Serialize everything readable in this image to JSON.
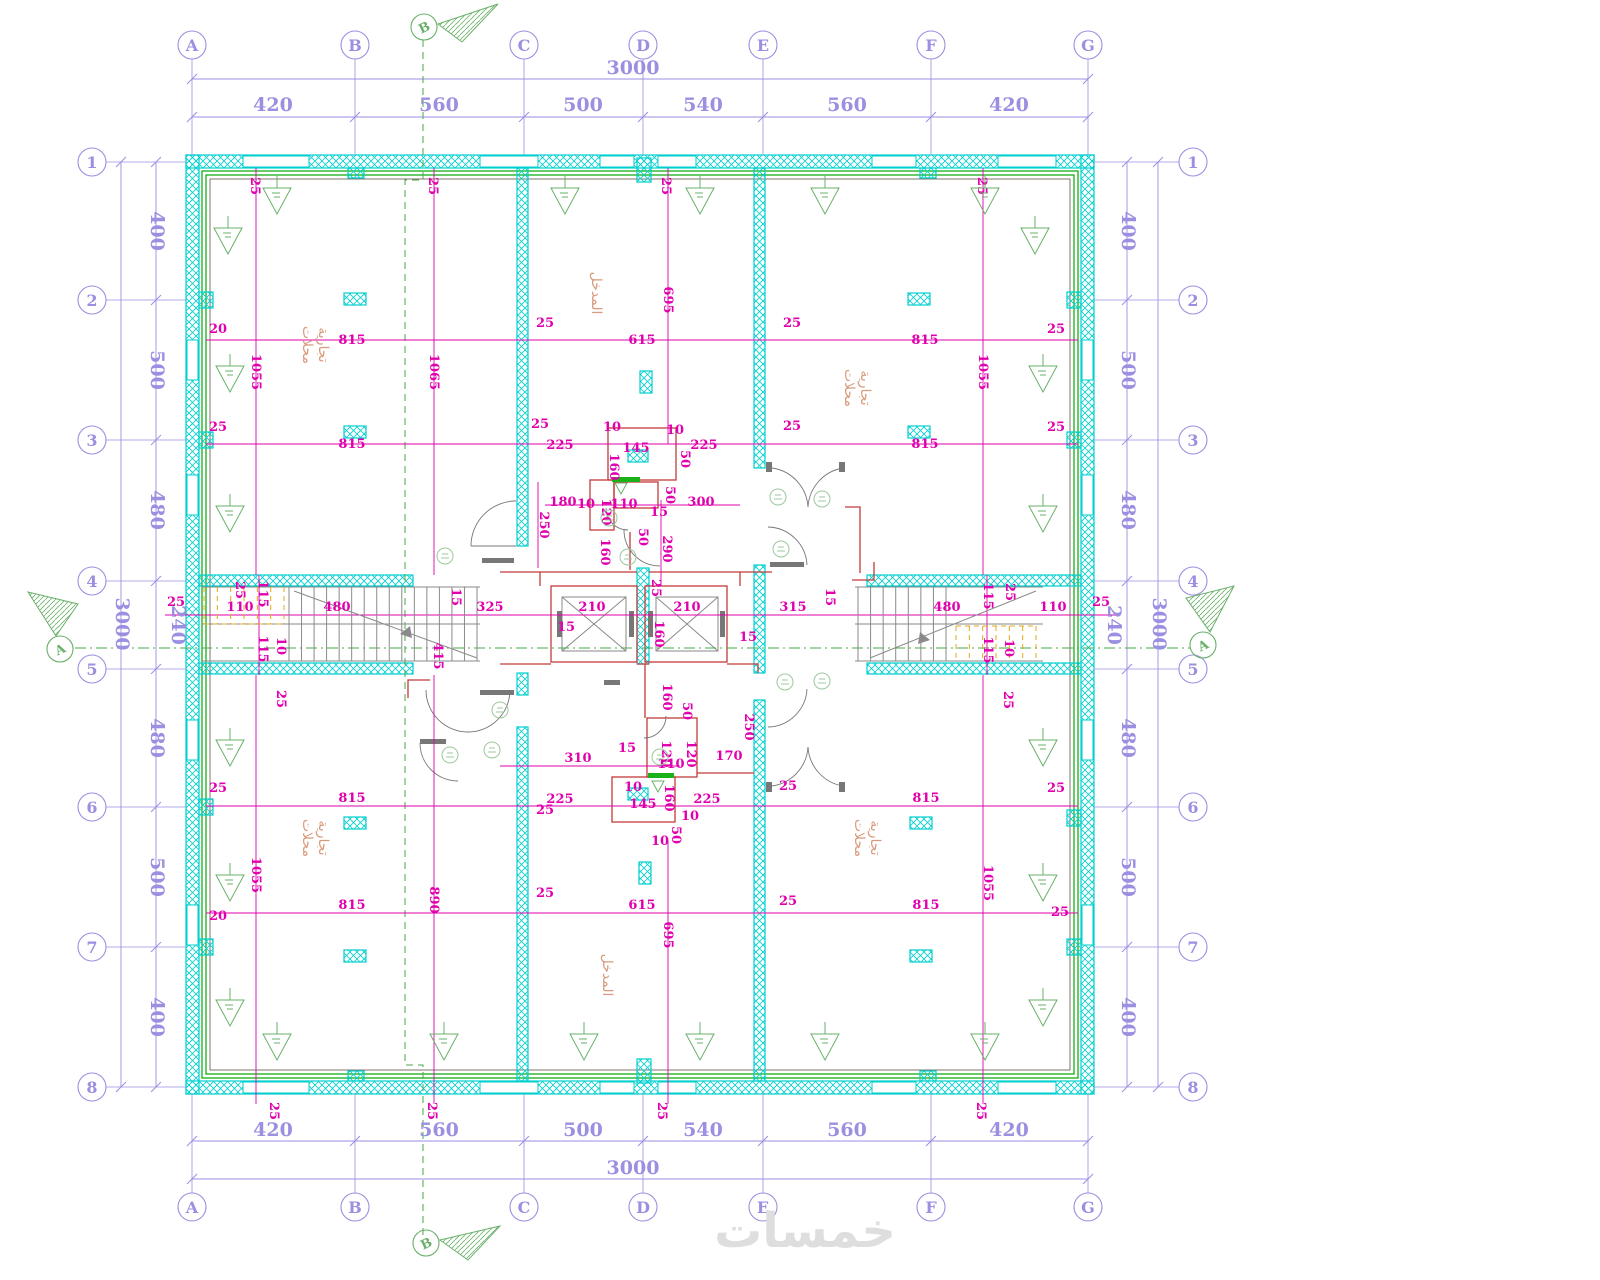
{
  "watermark": "خمسات",
  "colors": {
    "wall_cyan": "#00cfcf",
    "dim_magenta": "#e100ad",
    "axis_purple": "#9a8fe0",
    "symbol_green": "#69b069",
    "wall_liner_green": "#00a800",
    "core_red": "#c23a3a",
    "stair_yellow": "#e3a81c",
    "room_text_salmon": "#d99b7d",
    "watermark_gray": "#dedede"
  },
  "grid": {
    "cols": [
      {
        "label": "A",
        "x": 192
      },
      {
        "label": "B",
        "x": 355
      },
      {
        "label": "C",
        "x": 524
      },
      {
        "label": "D",
        "x": 643
      },
      {
        "label": "E",
        "x": 763
      },
      {
        "label": "F",
        "x": 931
      },
      {
        "label": "G",
        "x": 1088
      }
    ],
    "rows": [
      {
        "label": "1",
        "y": 162
      },
      {
        "label": "2",
        "y": 300
      },
      {
        "label": "3",
        "y": 440
      },
      {
        "label": "4",
        "y": 581
      },
      {
        "label": "5",
        "y": 669
      },
      {
        "label": "6",
        "y": 807
      },
      {
        "label": "7",
        "y": 947
      },
      {
        "label": "8",
        "y": 1087
      }
    ]
  },
  "axis_dims": [
    {
      "t": "3000",
      "x": 633,
      "y": 74
    },
    {
      "t": "420",
      "x": 273,
      "y": 111
    },
    {
      "t": "560",
      "x": 439,
      "y": 111
    },
    {
      "t": "500",
      "x": 583,
      "y": 111
    },
    {
      "t": "540",
      "x": 703,
      "y": 111
    },
    {
      "t": "560",
      "x": 847,
      "y": 111
    },
    {
      "t": "420",
      "x": 1009,
      "y": 111
    },
    {
      "t": "3000",
      "x": 633,
      "y": 1174
    },
    {
      "t": "420",
      "x": 273,
      "y": 1136
    },
    {
      "t": "560",
      "x": 439,
      "y": 1136
    },
    {
      "t": "500",
      "x": 583,
      "y": 1136
    },
    {
      "t": "540",
      "x": 703,
      "y": 1136
    },
    {
      "t": "560",
      "x": 847,
      "y": 1136
    },
    {
      "t": "420",
      "x": 1009,
      "y": 1136
    },
    {
      "t": "3000",
      "x": 116,
      "y": 624,
      "v": 1
    },
    {
      "t": "400",
      "x": 151,
      "y": 231,
      "v": 1
    },
    {
      "t": "500",
      "x": 151,
      "y": 370,
      "v": 1
    },
    {
      "t": "480",
      "x": 151,
      "y": 510,
      "v": 1
    },
    {
      "t": "240",
      "x": 172,
      "y": 625,
      "v": 1
    },
    {
      "t": "480",
      "x": 151,
      "y": 738,
      "v": 1
    },
    {
      "t": "500",
      "x": 151,
      "y": 877,
      "v": 1
    },
    {
      "t": "400",
      "x": 151,
      "y": 1017,
      "v": 1
    },
    {
      "t": "3000",
      "x": 1153,
      "y": 624,
      "v": 1
    },
    {
      "t": "400",
      "x": 1122,
      "y": 231,
      "v": 1
    },
    {
      "t": "500",
      "x": 1122,
      "y": 370,
      "v": 1
    },
    {
      "t": "480",
      "x": 1122,
      "y": 510,
      "v": 1
    },
    {
      "t": "240",
      "x": 1108,
      "y": 625,
      "v": 1
    },
    {
      "t": "480",
      "x": 1122,
      "y": 738,
      "v": 1
    },
    {
      "t": "500",
      "x": 1122,
      "y": 877,
      "v": 1
    },
    {
      "t": "400",
      "x": 1122,
      "y": 1017,
      "v": 1
    }
  ],
  "dim_labels": [
    {
      "t": "25",
      "x": 251,
      "y": 186,
      "v": 1,
      "fs": 11
    },
    {
      "t": "25",
      "x": 429,
      "y": 186,
      "v": 1,
      "fs": 11
    },
    {
      "t": "25",
      "x": 662,
      "y": 186,
      "v": 1,
      "fs": 11
    },
    {
      "t": "25",
      "x": 978,
      "y": 186,
      "v": 1,
      "fs": 11
    },
    {
      "t": "815",
      "x": 352,
      "y": 344
    },
    {
      "t": "615",
      "x": 642,
      "y": 344
    },
    {
      "t": "815",
      "x": 925,
      "y": 344
    },
    {
      "t": "20",
      "x": 218,
      "y": 333,
      "fs": 11
    },
    {
      "t": "25",
      "x": 545,
      "y": 327,
      "fs": 11
    },
    {
      "t": "25",
      "x": 792,
      "y": 327,
      "fs": 11
    },
    {
      "t": "25",
      "x": 1056,
      "y": 333,
      "fs": 11
    },
    {
      "t": "1055",
      "x": 252,
      "y": 372,
      "v": 1
    },
    {
      "t": "1065",
      "x": 430,
      "y": 372,
      "v": 1
    },
    {
      "t": "695",
      "x": 664,
      "y": 300,
      "v": 1
    },
    {
      "t": "1055",
      "x": 979,
      "y": 372,
      "v": 1
    },
    {
      "t": "815",
      "x": 352,
      "y": 448
    },
    {
      "t": "815",
      "x": 925,
      "y": 448
    },
    {
      "t": "225",
      "x": 560,
      "y": 449
    },
    {
      "t": "145",
      "x": 636,
      "y": 452,
      "fs": 10
    },
    {
      "t": "225",
      "x": 704,
      "y": 449
    },
    {
      "t": "25",
      "x": 218,
      "y": 431,
      "fs": 11
    },
    {
      "t": "25",
      "x": 540,
      "y": 428,
      "fs": 11
    },
    {
      "t": "25",
      "x": 792,
      "y": 430,
      "fs": 11
    },
    {
      "t": "25",
      "x": 1056,
      "y": 431,
      "fs": 11
    },
    {
      "t": "10",
      "x": 612,
      "y": 431,
      "fs": 9
    },
    {
      "t": "10",
      "x": 675,
      "y": 434,
      "fs": 9
    },
    {
      "t": "50",
      "x": 681,
      "y": 459,
      "v": 1,
      "fs": 9
    },
    {
      "t": "160",
      "x": 610,
      "y": 467,
      "v": 1,
      "fs": 9
    },
    {
      "t": "50",
      "x": 666,
      "y": 495,
      "v": 1,
      "fs": 9
    },
    {
      "t": "180",
      "x": 563,
      "y": 506,
      "fs": 10
    },
    {
      "t": "10",
      "x": 586,
      "y": 508,
      "fs": 9
    },
    {
      "t": "120",
      "x": 602,
      "y": 512,
      "v": 1,
      "fs": 9
    },
    {
      "t": "110",
      "x": 624,
      "y": 508,
      "fs": 10
    },
    {
      "t": "300",
      "x": 701,
      "y": 506,
      "fs": 10
    },
    {
      "t": "15",
      "x": 659,
      "y": 516,
      "fs": 10
    },
    {
      "t": "250",
      "x": 540,
      "y": 525,
      "v": 1,
      "fs": 10
    },
    {
      "t": "160",
      "x": 601,
      "y": 552,
      "v": 1,
      "fs": 9
    },
    {
      "t": "290",
      "x": 663,
      "y": 549,
      "v": 1
    },
    {
      "t": "50",
      "x": 639,
      "y": 537,
      "v": 1,
      "fs": 9
    },
    {
      "t": "25",
      "x": 176,
      "y": 606,
      "fs": 11
    },
    {
      "t": "110",
      "x": 240,
      "y": 611
    },
    {
      "t": "480",
      "x": 337,
      "y": 611
    },
    {
      "t": "325",
      "x": 490,
      "y": 611
    },
    {
      "t": "210",
      "x": 592,
      "y": 611
    },
    {
      "t": "210",
      "x": 687,
      "y": 611
    },
    {
      "t": "315",
      "x": 793,
      "y": 611
    },
    {
      "t": "480",
      "x": 947,
      "y": 611
    },
    {
      "t": "110",
      "x": 1053,
      "y": 611
    },
    {
      "t": "25",
      "x": 1101,
      "y": 606,
      "fs": 11
    },
    {
      "t": "115",
      "x": 259,
      "y": 594,
      "v": 1,
      "fs": 11
    },
    {
      "t": "115",
      "x": 259,
      "y": 649,
      "v": 1,
      "fs": 11
    },
    {
      "t": "10",
      "x": 277,
      "y": 646,
      "v": 1,
      "fs": 9
    },
    {
      "t": "25",
      "x": 236,
      "y": 590,
      "v": 1,
      "fs": 11
    },
    {
      "t": "25",
      "x": 277,
      "y": 699,
      "v": 1,
      "fs": 11
    },
    {
      "t": "15",
      "x": 452,
      "y": 597,
      "v": 1,
      "fs": 11
    },
    {
      "t": "415",
      "x": 434,
      "y": 656,
      "v": 1
    },
    {
      "t": "15",
      "x": 566,
      "y": 631,
      "fs": 11
    },
    {
      "t": "15",
      "x": 748,
      "y": 641,
      "fs": 11
    },
    {
      "t": "160",
      "x": 655,
      "y": 634,
      "v": 1,
      "fs": 10
    },
    {
      "t": "25",
      "x": 652,
      "y": 588,
      "v": 1,
      "fs": 10
    },
    {
      "t": "115",
      "x": 984,
      "y": 596,
      "v": 1,
      "fs": 11
    },
    {
      "t": "115",
      "x": 984,
      "y": 650,
      "v": 1,
      "fs": 11
    },
    {
      "t": "10",
      "x": 1005,
      "y": 648,
      "v": 1,
      "fs": 9
    },
    {
      "t": "25",
      "x": 1006,
      "y": 592,
      "v": 1,
      "fs": 11
    },
    {
      "t": "25",
      "x": 1004,
      "y": 700,
      "v": 1,
      "fs": 11
    },
    {
      "t": "15",
      "x": 826,
      "y": 597,
      "v": 1,
      "fs": 11
    },
    {
      "t": "310",
      "x": 578,
      "y": 762,
      "fs": 10
    },
    {
      "t": "15",
      "x": 627,
      "y": 752,
      "fs": 10
    },
    {
      "t": "120",
      "x": 662,
      "y": 754,
      "v": 1,
      "fs": 9
    },
    {
      "t": "120",
      "x": 687,
      "y": 754,
      "v": 1,
      "fs": 9
    },
    {
      "t": "170",
      "x": 729,
      "y": 760,
      "fs": 10
    },
    {
      "t": "110",
      "x": 671,
      "y": 768,
      "fs": 10
    },
    {
      "t": "160",
      "x": 663,
      "y": 697,
      "v": 1,
      "fs": 9
    },
    {
      "t": "50",
      "x": 683,
      "y": 711,
      "v": 1,
      "fs": 9
    },
    {
      "t": "250",
      "x": 745,
      "y": 727,
      "v": 1,
      "fs": 10
    },
    {
      "t": "160",
      "x": 665,
      "y": 798,
      "v": 1,
      "fs": 9
    },
    {
      "t": "10",
      "x": 633,
      "y": 791,
      "fs": 9
    },
    {
      "t": "10",
      "x": 690,
      "y": 820,
      "fs": 9
    },
    {
      "t": "50",
      "x": 672,
      "y": 835,
      "v": 1,
      "fs": 9
    },
    {
      "t": "10",
      "x": 660,
      "y": 845,
      "fs": 9
    },
    {
      "t": "225",
      "x": 560,
      "y": 803
    },
    {
      "t": "145",
      "x": 643,
      "y": 808,
      "fs": 10
    },
    {
      "t": "225",
      "x": 707,
      "y": 803
    },
    {
      "t": "815",
      "x": 352,
      "y": 802
    },
    {
      "t": "815",
      "x": 926,
      "y": 802
    },
    {
      "t": "25",
      "x": 218,
      "y": 792,
      "fs": 11
    },
    {
      "t": "25",
      "x": 545,
      "y": 814,
      "fs": 11
    },
    {
      "t": "25",
      "x": 788,
      "y": 790,
      "fs": 11
    },
    {
      "t": "25",
      "x": 1056,
      "y": 792,
      "fs": 11
    },
    {
      "t": "1055",
      "x": 252,
      "y": 875,
      "v": 1
    },
    {
      "t": "890",
      "x": 430,
      "y": 900,
      "v": 1
    },
    {
      "t": "695",
      "x": 664,
      "y": 935,
      "v": 1
    },
    {
      "t": "1055",
      "x": 984,
      "y": 883,
      "v": 1
    },
    {
      "t": "815",
      "x": 352,
      "y": 909
    },
    {
      "t": "615",
      "x": 642,
      "y": 909
    },
    {
      "t": "815",
      "x": 926,
      "y": 909
    },
    {
      "t": "20",
      "x": 218,
      "y": 920,
      "fs": 11
    },
    {
      "t": "25",
      "x": 545,
      "y": 897,
      "fs": 11
    },
    {
      "t": "25",
      "x": 788,
      "y": 905,
      "fs": 11
    },
    {
      "t": "25",
      "x": 1060,
      "y": 916,
      "fs": 11
    },
    {
      "t": "25",
      "x": 270,
      "y": 1111,
      "v": 1,
      "fs": 11
    },
    {
      "t": "25",
      "x": 428,
      "y": 1111,
      "v": 1,
      "fs": 11
    },
    {
      "t": "25",
      "x": 658,
      "y": 1111,
      "v": 1,
      "fs": 11
    },
    {
      "t": "25",
      "x": 977,
      "y": 1111,
      "v": 1,
      "fs": 11
    }
  ],
  "room_labels": [
    {
      "t": "محلات",
      "x": 303,
      "y": 345
    },
    {
      "t": "تجارية",
      "x": 319,
      "y": 345
    },
    {
      "t": "محلات",
      "x": 845,
      "y": 388
    },
    {
      "t": "تجارية",
      "x": 861,
      "y": 388
    },
    {
      "t": "محلات",
      "x": 303,
      "y": 838
    },
    {
      "t": "تجارية",
      "x": 319,
      "y": 838
    },
    {
      "t": "محلات",
      "x": 855,
      "y": 838
    },
    {
      "t": "تجارية",
      "x": 871,
      "y": 838
    },
    {
      "t": "المدخل",
      "x": 592,
      "y": 293
    },
    {
      "t": "المدخل",
      "x": 603,
      "y": 975
    }
  ],
  "wall_tags": [
    {
      "x": 277,
      "y": 200
    },
    {
      "x": 565,
      "y": 200
    },
    {
      "x": 700,
      "y": 200
    },
    {
      "x": 825,
      "y": 200
    },
    {
      "x": 985,
      "y": 200
    },
    {
      "x": 228,
      "y": 240
    },
    {
      "x": 1035,
      "y": 240
    },
    {
      "x": 230,
      "y": 378
    },
    {
      "x": 230,
      "y": 518
    },
    {
      "x": 230,
      "y": 752
    },
    {
      "x": 230,
      "y": 887
    },
    {
      "x": 230,
      "y": 1012
    },
    {
      "x": 1043,
      "y": 378
    },
    {
      "x": 1043,
      "y": 518
    },
    {
      "x": 1043,
      "y": 752
    },
    {
      "x": 1043,
      "y": 887
    },
    {
      "x": 1043,
      "y": 1012
    },
    {
      "x": 277,
      "y": 1046
    },
    {
      "x": 444,
      "y": 1046
    },
    {
      "x": 584,
      "y": 1046
    },
    {
      "x": 700,
      "y": 1046
    },
    {
      "x": 825,
      "y": 1046
    },
    {
      "x": 985,
      "y": 1046
    }
  ],
  "door_tags": [
    {
      "x": 778,
      "y": 497
    },
    {
      "x": 822,
      "y": 499
    },
    {
      "x": 781,
      "y": 549
    },
    {
      "x": 609,
      "y": 518
    },
    {
      "x": 628,
      "y": 557
    },
    {
      "x": 445,
      "y": 556
    },
    {
      "x": 785,
      "y": 682
    },
    {
      "x": 822,
      "y": 681
    },
    {
      "x": 660,
      "y": 757
    },
    {
      "x": 500,
      "y": 710
    },
    {
      "x": 450,
      "y": 755
    },
    {
      "x": 492,
      "y": 750
    }
  ],
  "sections": [
    {
      "label": "B",
      "x": 424,
      "y": 27,
      "wedge": "438,24 498,4 462,42"
    },
    {
      "label": "B",
      "x": 426,
      "y": 1243,
      "wedge": "440,1240 500,1226 468,1260"
    },
    {
      "label": "A",
      "x": 60,
      "y": 649,
      "wedge": "56,636 28,592 78,604"
    },
    {
      "label": "A",
      "x": 1203,
      "y": 645,
      "wedge": "1210,632 1234,586 1186,598"
    }
  ]
}
